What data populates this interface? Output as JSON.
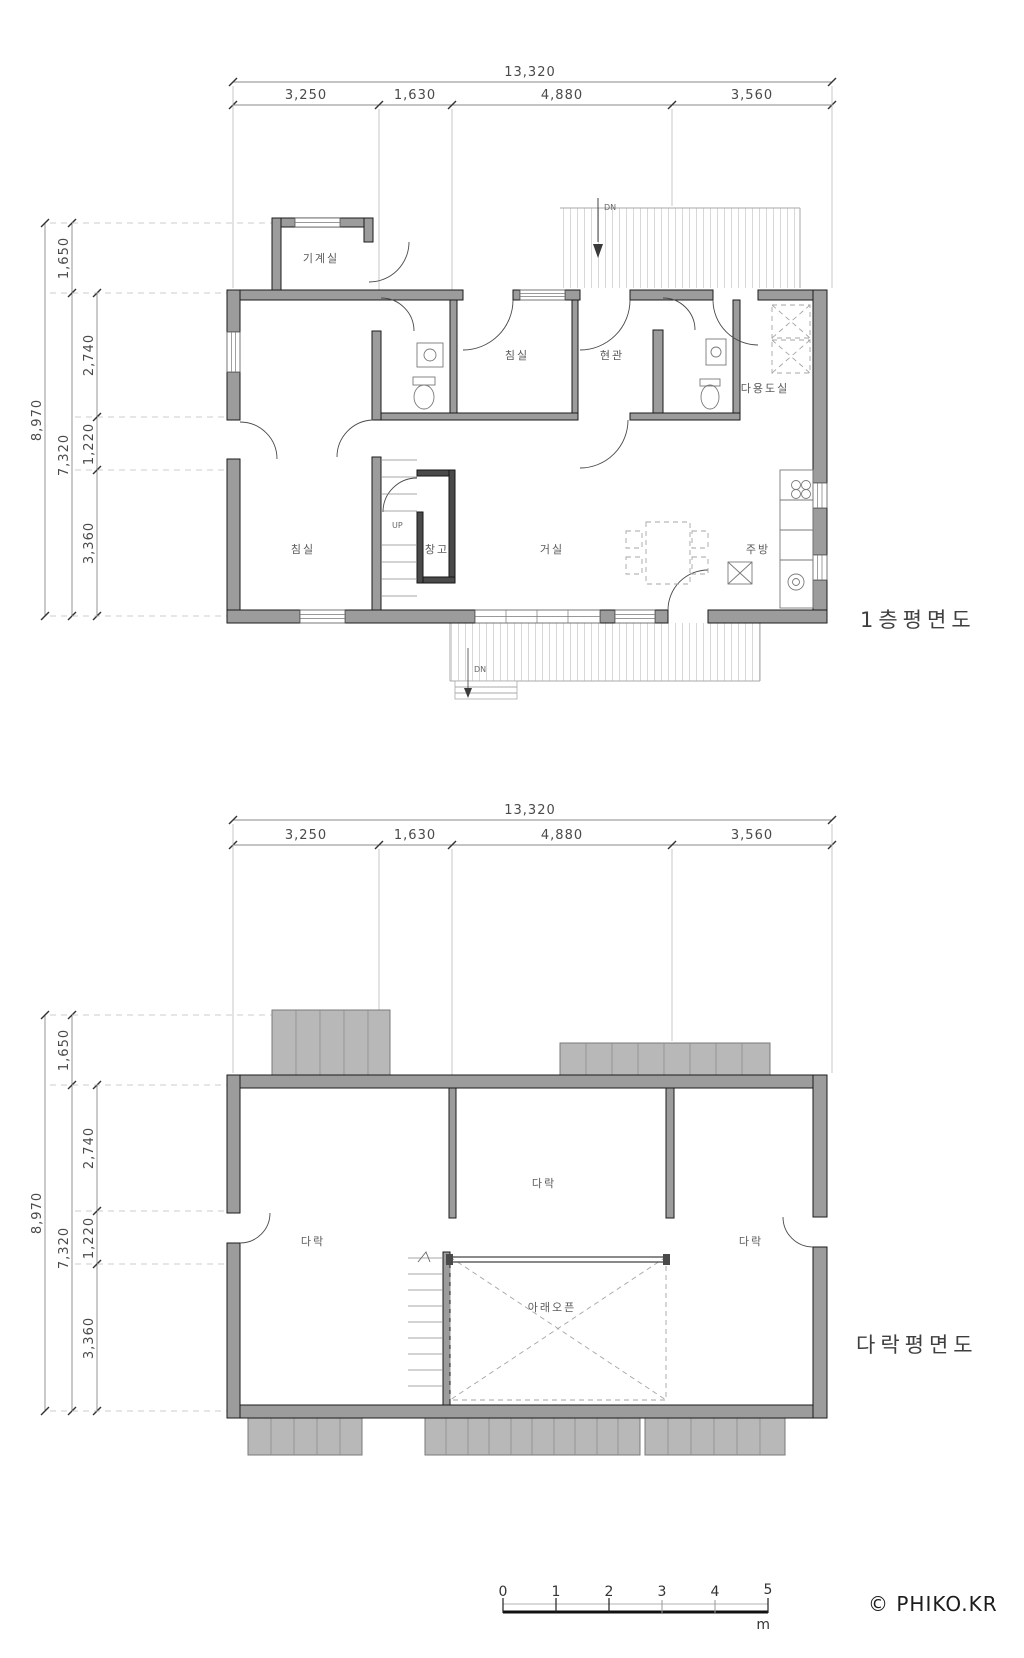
{
  "first_floor": {
    "title": "1층평면도",
    "dim_total_w": "13,320",
    "dim_w": [
      "3,250",
      "1,630",
      "4,880",
      "3,560"
    ],
    "dim_total_h": "8,970",
    "dim_sub_h": "7,320",
    "dim_h": [
      "1,650",
      "2,740",
      "1,220",
      "3,360"
    ],
    "rooms": {
      "machine": "기계실",
      "bedroom_top": "침실",
      "entry": "현관",
      "utility": "다용도실",
      "bedroom": "침실",
      "storage": "창고",
      "living": "거실",
      "kitchen": "주방"
    },
    "stair_up_label": "UP",
    "deck_dn_label": "DN",
    "porch_dn_label": "DN"
  },
  "attic": {
    "title": "다락평면도",
    "dim_total_w": "13,320",
    "dim_w": [
      "3,250",
      "1,630",
      "4,880",
      "3,560"
    ],
    "dim_total_h": "8,970",
    "dim_sub_h": "7,320",
    "dim_h": [
      "1,650",
      "2,740",
      "1,220",
      "3,360"
    ],
    "rooms": {
      "attic_center": "다락",
      "attic_left": "다락",
      "attic_right": "다락",
      "open_below": "아래오픈"
    }
  },
  "scale_bar": {
    "ticks": [
      "0",
      "1",
      "2",
      "3",
      "4",
      "5"
    ],
    "unit": "m"
  },
  "credit": "© PHIKO.KR",
  "colors": {
    "wall_fill": "#9c9c9c",
    "roof_fill": "#b8b8b8",
    "line": "#4a4a4a",
    "paper": "#ffffff"
  }
}
